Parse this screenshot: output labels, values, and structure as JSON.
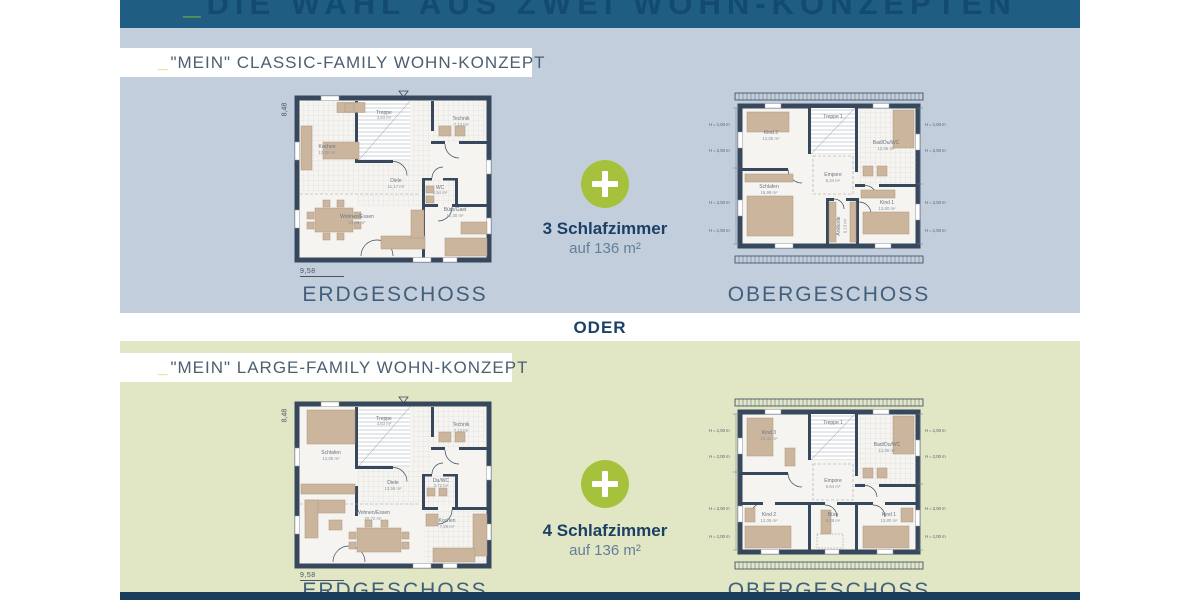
{
  "banner": {
    "underscore": "_",
    "title": "DIE WAHL AUS ZWEI WOHN-KONZEPTEN"
  },
  "divider": {
    "label": "ODER"
  },
  "sections": {
    "classic": {
      "underscore": "_",
      "heading": "\"MEIN\" CLASSIC-FAMILY WOHN-KONZEPT",
      "benefit_title": "3 Schlafzimmer",
      "benefit_sub": "auf 136 m²",
      "floor_left": "ERDGESCHOSS",
      "floor_right": "OBERGESCHOSS"
    },
    "large": {
      "underscore": "_",
      "heading": "\"MEIN\" LARGE-FAMILY WOHN-KONZEPT",
      "benefit_title": "4 Schlafzimmer",
      "benefit_sub": "auf 136 m²",
      "floor_left": "ERDGESCHOSS",
      "floor_right": "OBERGESCHOSS"
    }
  },
  "plans": {
    "classic_eg": {
      "dims": {
        "width": "9,58",
        "height": "8,48"
      },
      "rooms": {
        "kochen": {
          "name": "Kochen",
          "area": "12,06 m²"
        },
        "treppe": {
          "name": "Treppe",
          "area": "3,83 m²"
        },
        "technik": {
          "name": "Technik",
          "area": "7,13 m²"
        },
        "diele": {
          "name": "Diele",
          "area": "11,17 m²"
        },
        "wc": {
          "name": "WC",
          "area": "1,54 m²"
        },
        "wohnen": {
          "name": "Wohnen/Essen",
          "area": "21,09 m²"
        },
        "buero": {
          "name": "Büro/Gast",
          "area": "10,30 m²"
        }
      }
    },
    "classic_og": {
      "side_labels": [
        "H = 1,00 m",
        "H = 2,00 m",
        "H = 2,00 m",
        "H = 1,00 m"
      ],
      "rooms": {
        "kind2": {
          "name": "Kind 2",
          "area": "12,05 m²"
        },
        "treppe": {
          "name": "Treppe 1",
          "area": ""
        },
        "bad": {
          "name": "Bad/Du/WC",
          "area": "12,06 m²"
        },
        "empore": {
          "name": "Empore",
          "area": "5,34 m²"
        },
        "schlafen": {
          "name": "Schlafen",
          "area": "16,99 m²"
        },
        "ankleide": {
          "name": "Ankleide",
          "area": "9,13 m²"
        },
        "kind1": {
          "name": "Kind 1",
          "area": "13,80 m²"
        }
      }
    },
    "large_eg": {
      "dims": {
        "width": "9,58",
        "height": "8,48"
      },
      "rooms": {
        "schlafen": {
          "name": "Schlafen",
          "area": "12,06 m²"
        },
        "treppe": {
          "name": "Treppe",
          "area": "3,83 m²"
        },
        "technik": {
          "name": "Technik",
          "area": "7,13 m²"
        },
        "diele": {
          "name": "Diele",
          "area": "13,59 m²"
        },
        "duwc": {
          "name": "Du/WC",
          "area": "3,72 m²"
        },
        "wohnen": {
          "name": "Wohnen/Essen",
          "area": "20,72 m²"
        },
        "kochen": {
          "name": "Kochen",
          "area": "7,29 m²"
        }
      }
    },
    "large_og": {
      "side_labels": [
        "H = 1,00 m",
        "H = 2,00 m",
        "H = 2,00 m",
        "H = 1,00 m"
      ],
      "rooms": {
        "kind3": {
          "name": "Kind 3",
          "area": "10,41 m²"
        },
        "treppe": {
          "name": "Treppe 1",
          "area": ""
        },
        "bad": {
          "name": "Bad/Du/WC",
          "area": "12,06 m²"
        },
        "empore": {
          "name": "Empore",
          "area": "6,94 m²"
        },
        "kind2": {
          "name": "Kind 2",
          "area": "12,05 m²"
        },
        "buero": {
          "name": "Büro",
          "area": "8,28 m²"
        },
        "kind1": {
          "name": "Kind 1",
          "area": "13,80 m²"
        }
      }
    }
  },
  "colors": {
    "banner_blue": "#1f5d82",
    "classic_panel": "#c3cedd",
    "large_panel": "#e1e6c4",
    "accent_green": "#a6c13c",
    "navy": "#1b4066",
    "wall": "#38485c"
  }
}
